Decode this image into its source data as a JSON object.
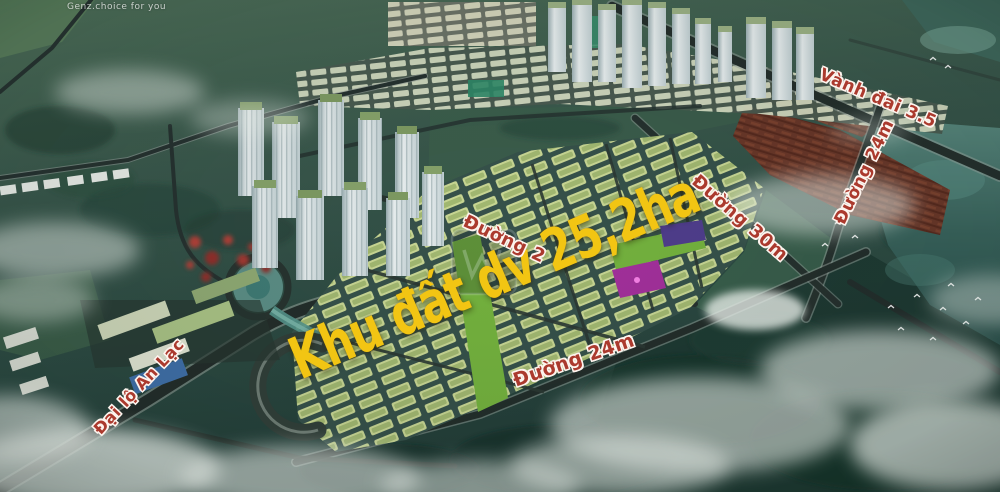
{
  "watermark": {
    "text": "Genz.choice for you"
  },
  "labels": {
    "main_area": "Khu đất dv 25,2ha",
    "ring_road": "Vành đai 3.5",
    "road_24m_east": "Đường 24m",
    "road_30m": "Đường 30m",
    "road_2x": "Đường 2",
    "road_24m_south": "Đường 24m",
    "boulevard": "Đại lộ An Lạc"
  },
  "colors": {
    "label_red": "#ab3a2e",
    "label_outline": "#fdf4ee",
    "highlight_yellow": "#f2c513"
  }
}
